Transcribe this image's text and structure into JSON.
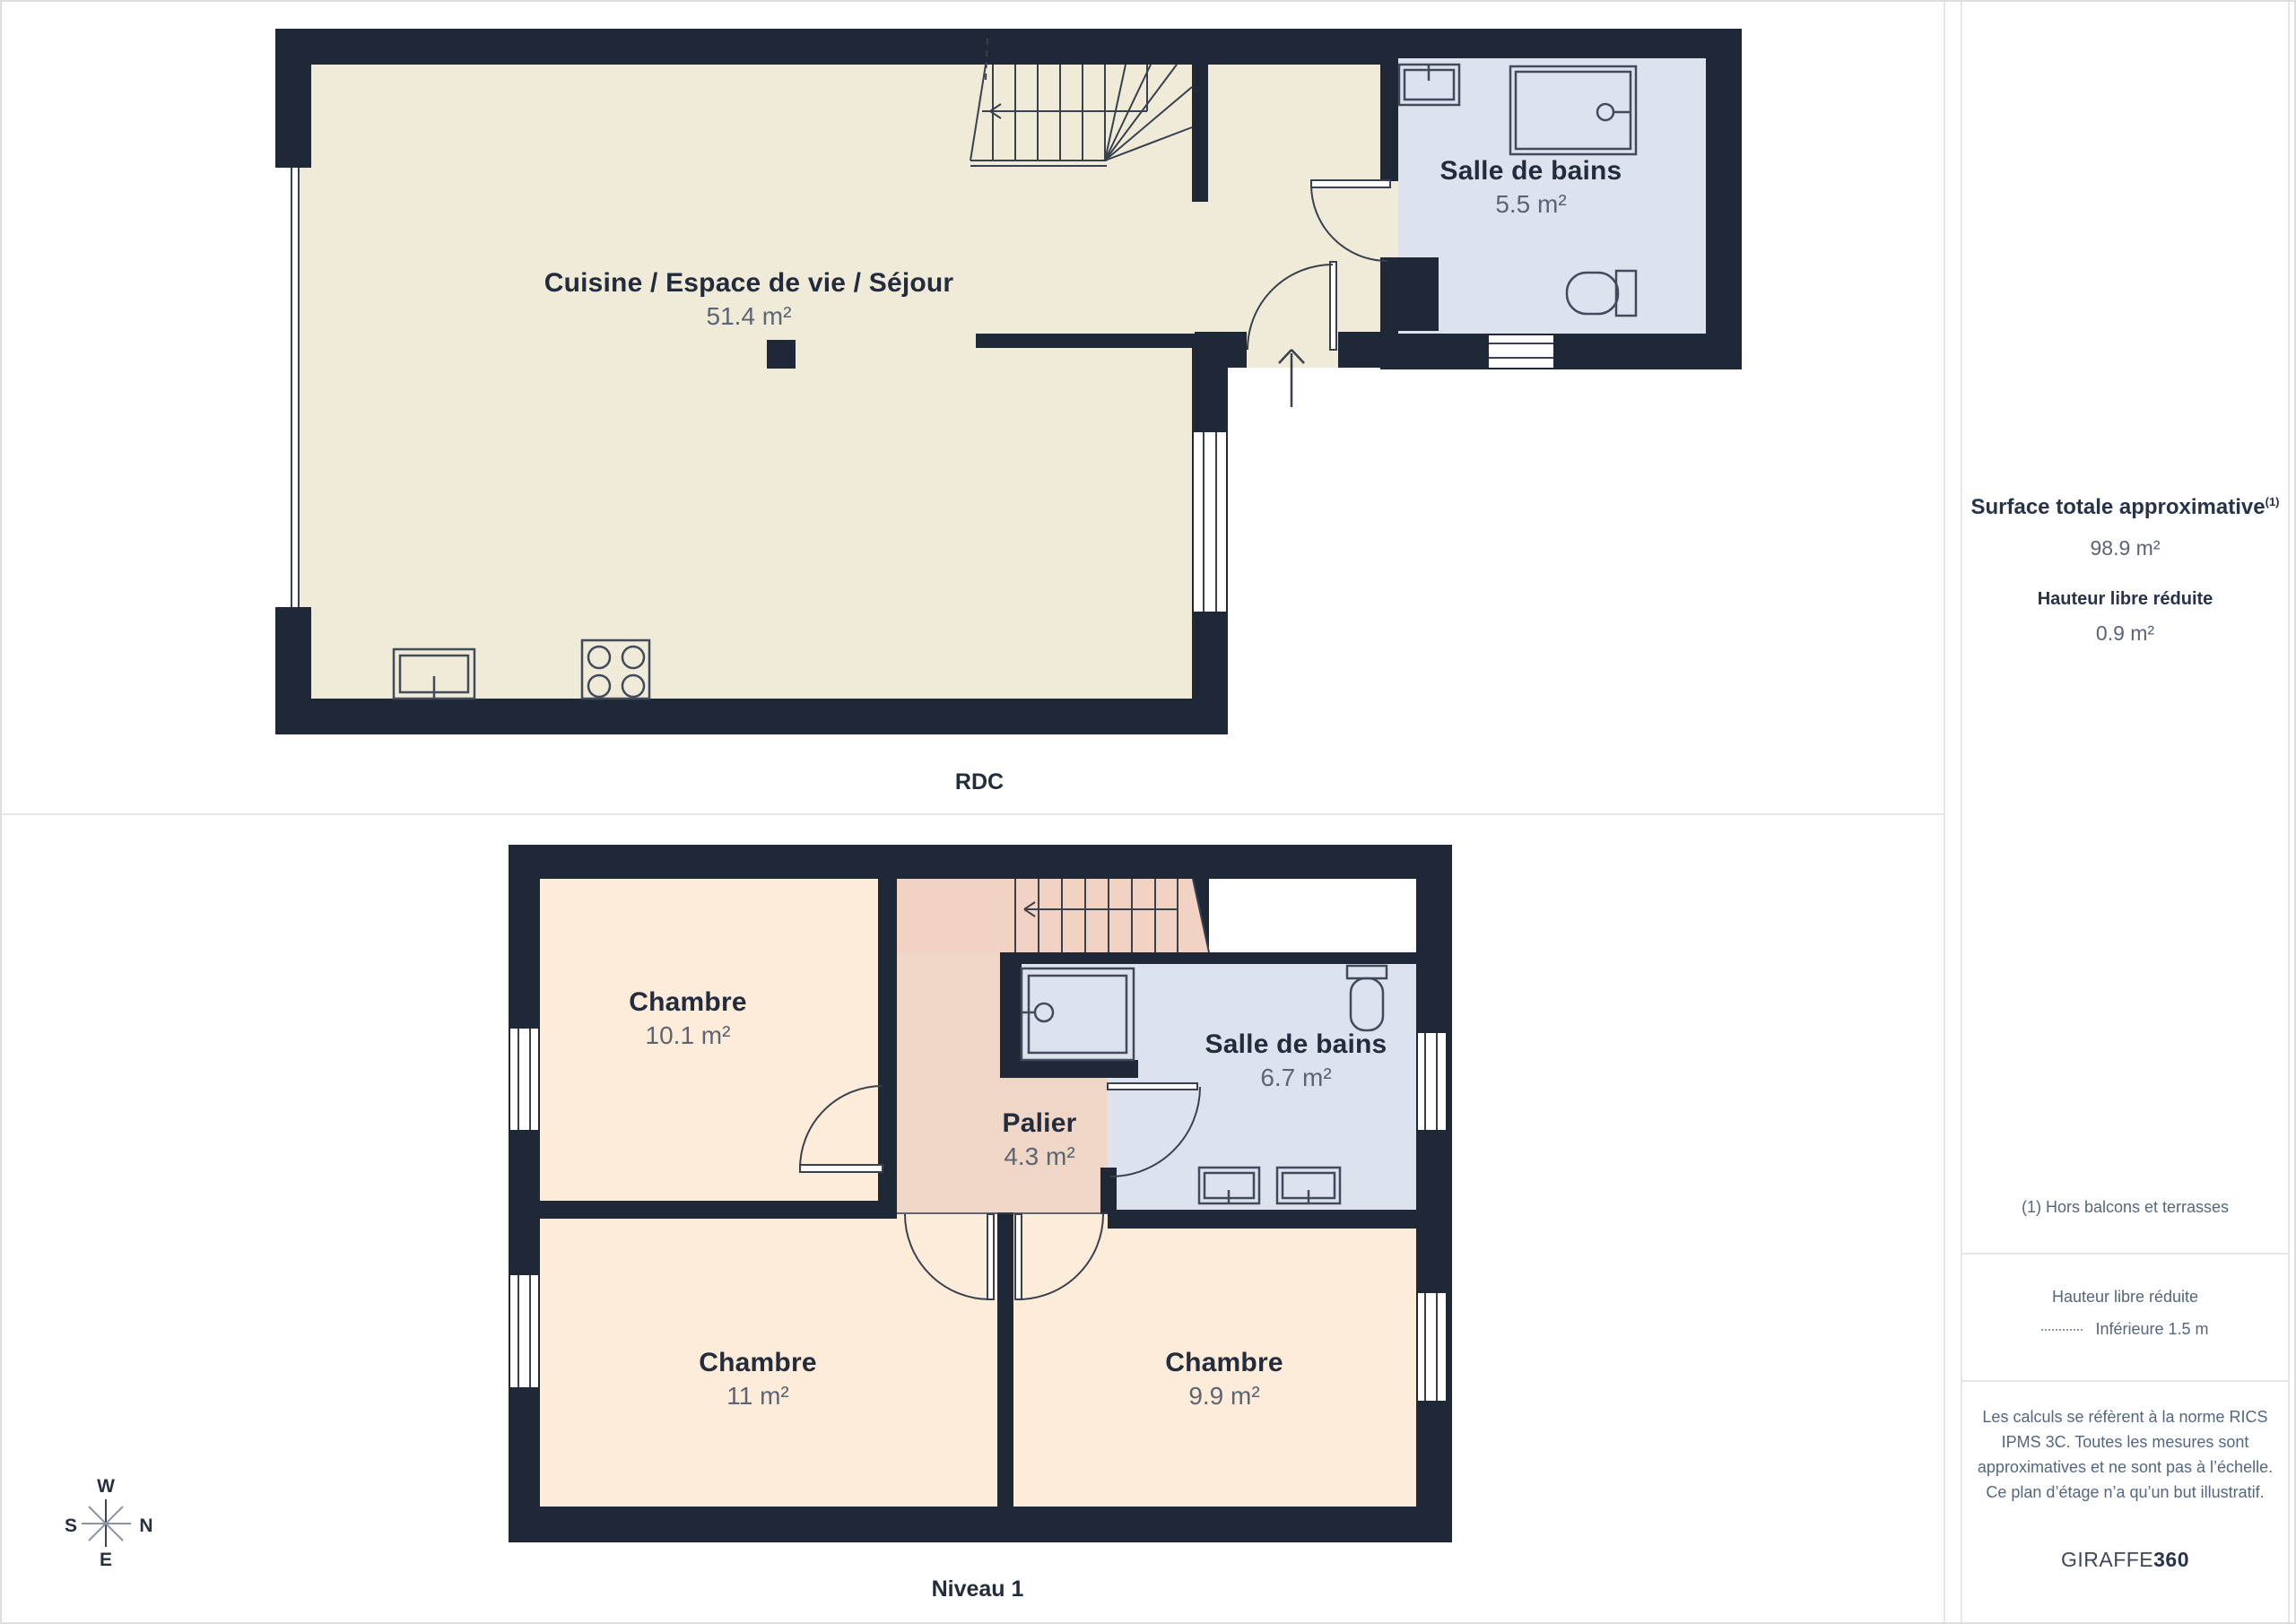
{
  "colors": {
    "wall_navy": "#1e2836",
    "floor_beige": "#f0ead8",
    "bathroom_blue": "#dde3ee",
    "bedroom_peach": "#fdecda",
    "stairs_salmon": "#f2d2c2",
    "palier_salmon": "#f0d6c6"
  },
  "floors": {
    "rdc": {
      "label": "RDC",
      "rooms": {
        "living": {
          "name": "Cuisine / Espace de vie / Séjour",
          "area": "51.4 m²"
        },
        "bathroom": {
          "name": "Salle de bains",
          "area": "5.5 m²"
        }
      }
    },
    "niveau1": {
      "label": "Niveau 1",
      "rooms": {
        "bedroom1": {
          "name": "Chambre",
          "area": "10.1 m²"
        },
        "palier": {
          "name": "Palier",
          "area": "4.3 m²"
        },
        "bathroom": {
          "name": "Salle de bains",
          "area": "6.7 m²"
        },
        "bedroom2": {
          "name": "Chambre",
          "area": "11 m²"
        },
        "bedroom3": {
          "name": "Chambre",
          "area": "9.9 m²"
        }
      }
    }
  },
  "compass": {
    "west": "W",
    "south": "S",
    "north": "N",
    "east": "E"
  },
  "sidebar": {
    "total_area": {
      "label": "Surface totale approximative",
      "footnote_marker": "(1)",
      "value": "98.9 m²"
    },
    "reduced_height": {
      "label": "Hauteur libre réduite",
      "value": "0.9 m²"
    },
    "footnote": "(1) Hors balcons et terrasses",
    "legend": {
      "title": "Hauteur libre réduite",
      "entry": "Inférieure 1.5 m"
    },
    "disclaimer": "Les calculs se réfèrent à la norme RICS IPMS 3C. Toutes les mesures sont approximatives et ne sont pas à l’échelle. Ce plan d’étage n’a qu’un but illustratif.",
    "brand": {
      "name": "GIRAFFE",
      "suffix": "360"
    }
  }
}
